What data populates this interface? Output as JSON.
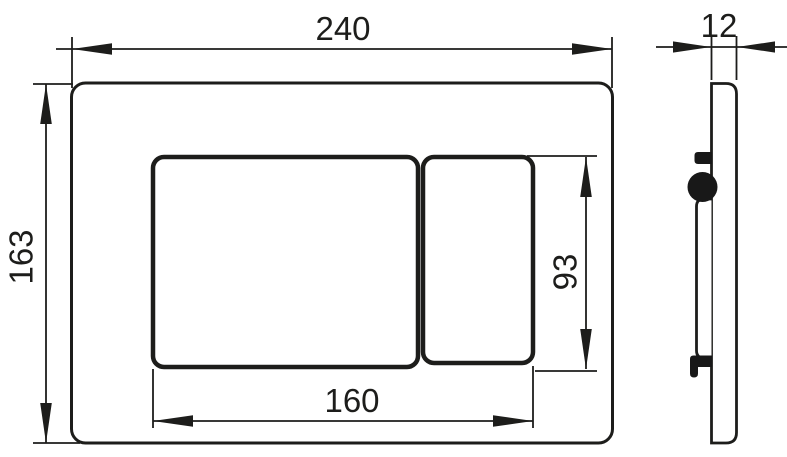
{
  "dimensions": {
    "front_width": "240",
    "front_height": "163",
    "button_area_width": "160",
    "button_area_height": "93",
    "side_thickness": "12"
  },
  "colors": {
    "line": "#1d1d1b",
    "background": "#ffffff"
  }
}
